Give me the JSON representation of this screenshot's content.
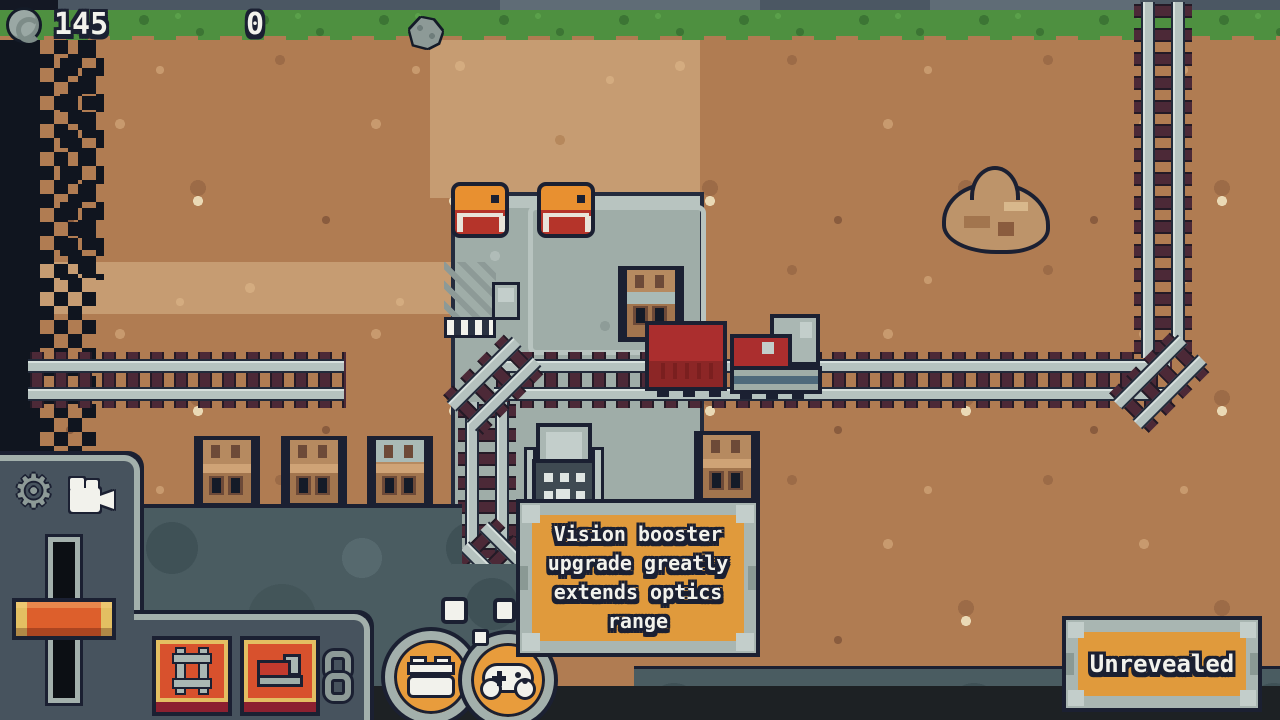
{
  "hud": {
    "coin_value": "145",
    "ore_value": "0"
  },
  "tooltip": {
    "line1": "Vision booster",
    "line2": "upgrade greatly",
    "line3": "extends optics",
    "line4": "range"
  },
  "labels": {
    "unrevealed": "Unrevealed"
  },
  "icons": {
    "coin": "coin-icon",
    "ore": "ore-rock-icon",
    "settings": "gear-icon",
    "camera": "camera-icon",
    "build_track": "railroad-track-icon",
    "buy_train": "train-icon",
    "link": "chain-link-icon",
    "workshop": "workbench-icon",
    "controls": "gamepad-icon"
  },
  "glyphs": {
    "gear": "⚙"
  },
  "colors": {
    "accent_orange": "#e09a3c",
    "button_red": "#d8512d",
    "button_yellow": "#e3bf62",
    "panel_slate": "#47535e",
    "steel_frame": "#a9b6b2",
    "outline_navy": "#1b2032",
    "train_red": "#ab2e2e",
    "platform_gray": "#9fada8",
    "dirt_brown": "#b07c52",
    "road_tan": "#c69c72",
    "grass_green": "#4e9040",
    "fog_teal": "#4a5c61"
  }
}
